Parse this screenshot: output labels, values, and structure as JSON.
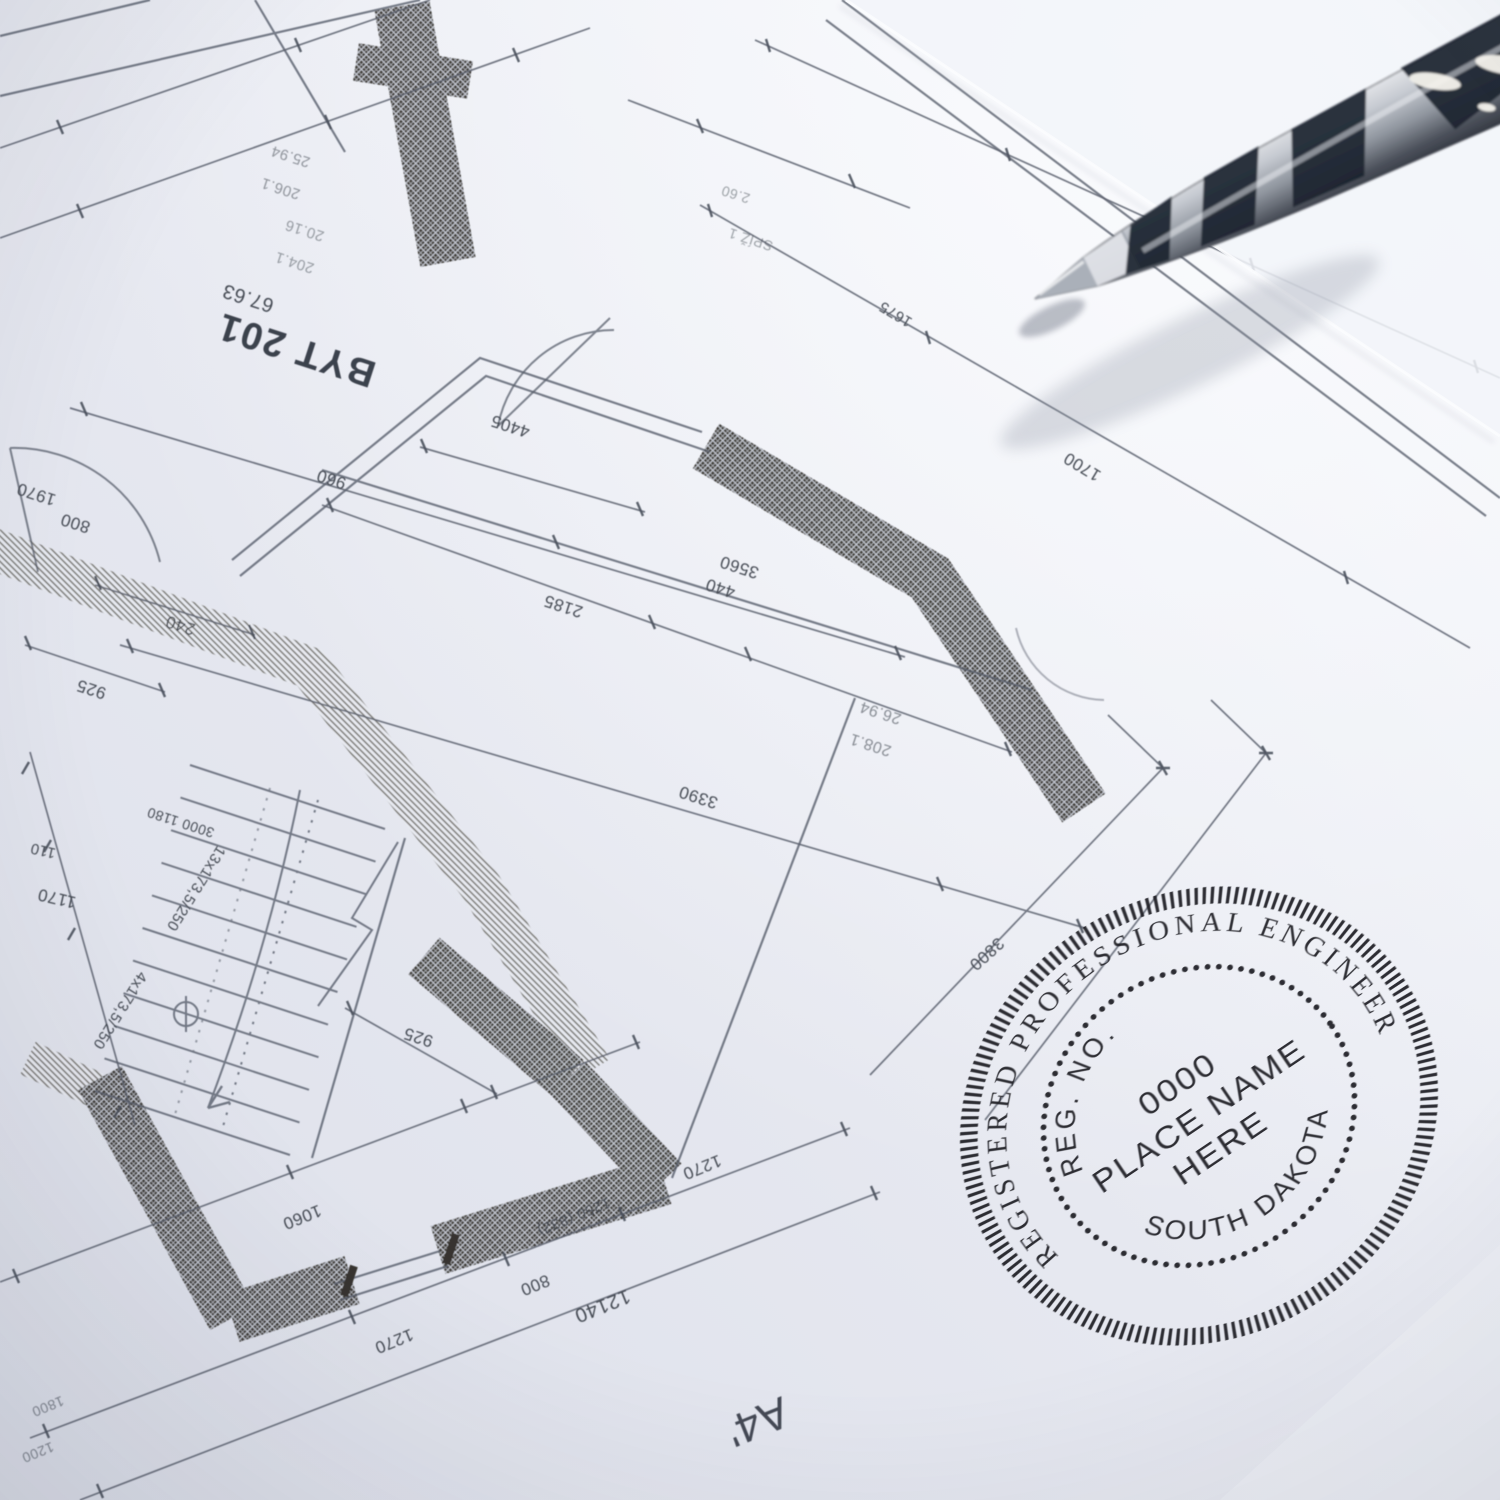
{
  "stamp": {
    "outer_text": "REGISTERED PROFESSIONAL ENGINEER",
    "reg_label": "REG. NO.",
    "line1": "0000",
    "line2": "PLACE NAME",
    "line3": "HERE",
    "state": "SOUTH DAKOTA",
    "ink_color": "#1e1f24"
  },
  "blueprint": {
    "title_label": "BYT 201",
    "labels": {
      "byt": "BYT 201",
      "byt_area": "67.63",
      "room_no_a": "206.1",
      "room_area_a": "25.94",
      "room_no_b": "204.1",
      "room_area_b": "20.16",
      "room_no_c": "208.1",
      "room_area_c": "26.94",
      "d960": "960",
      "d3560": "3560",
      "d4405": "4405",
      "d2185": "2185",
      "d440": "440",
      "d3390": "3390",
      "d240": "240",
      "d925a": "925",
      "d1970": "1970",
      "d800a": "800",
      "d110": "110",
      "d1170": "1170",
      "d925b": "925",
      "d3000": "3000 1180",
      "stair13": "13x173,5/250",
      "stair4": "4x173,5/250",
      "d1060": "1060",
      "d1270a": "1270",
      "d800b": "800",
      "d1250": "1250 (832)",
      "d1270b": "1270",
      "d12140": "12140",
      "d1200": "1200",
      "d1800": "1800",
      "d3800": "3800",
      "d1700": "1700",
      "d1675": "1675",
      "a4": "A4'",
      "spiz": "SPÍŽ 1",
      "s260": "2.60"
    },
    "line_color": "#4e5462",
    "wall_color": "#2d2a22"
  },
  "drill": {
    "name": "twist-drill-bit",
    "metal_dark": "#1c2430",
    "metal_light": "#dfe2e7"
  }
}
